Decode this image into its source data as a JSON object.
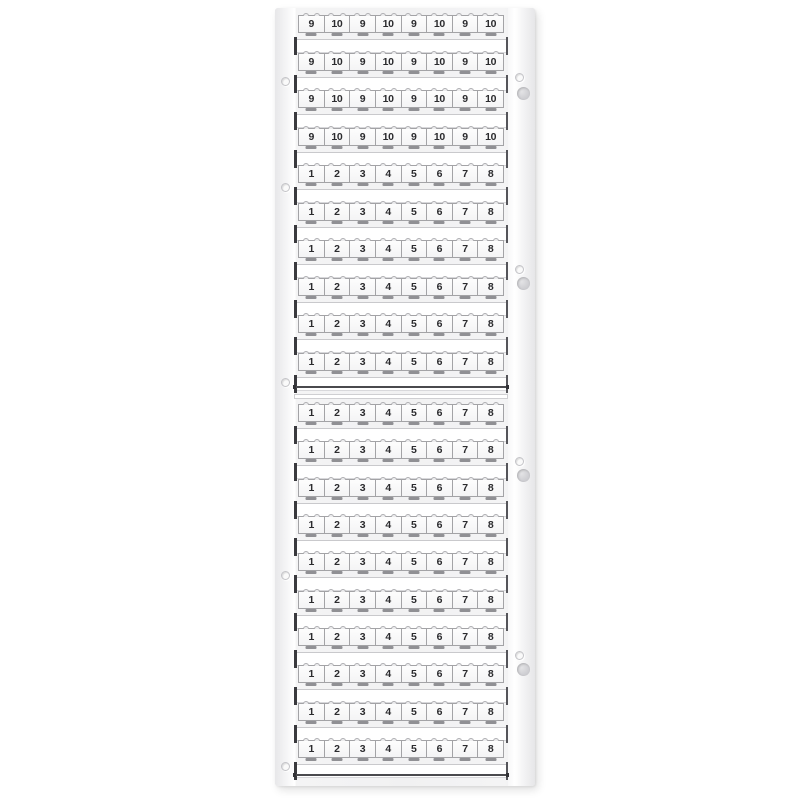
{
  "card": {
    "tag_rows": {
      "pattern_910": [
        "9",
        "10",
        "9",
        "10",
        "9",
        "10",
        "9",
        "10"
      ],
      "pattern_18": [
        "1",
        "2",
        "3",
        "4",
        "5",
        "6",
        "7",
        "8"
      ]
    },
    "sections": [
      {
        "name": "upper",
        "rows": [
          "pattern_910",
          "pattern_910",
          "pattern_910",
          "pattern_910",
          "pattern_18",
          "pattern_18",
          "pattern_18",
          "pattern_18",
          "pattern_18",
          "pattern_18"
        ]
      },
      {
        "name": "lower",
        "rows": [
          "pattern_18",
          "pattern_18",
          "pattern_18",
          "pattern_18",
          "pattern_18",
          "pattern_18",
          "pattern_18",
          "pattern_18",
          "pattern_18",
          "pattern_18"
        ]
      }
    ],
    "colors": {
      "page_background": "#ffffff",
      "card_body": "#f1f1f2",
      "tag_fill": "#fbfbfc",
      "tag_border": "#a3a3a6",
      "digit": "#2b2b2e",
      "blank_strip": "#ffffff",
      "end_bar": "#3a3a3e",
      "section_line": "#4a4a4e",
      "hole_ring": "#c4c4c8",
      "notch_fill": "#cfcfd3"
    },
    "left_holes_y": [
      69,
      175,
      370,
      563,
      754
    ],
    "right_holes_y": [
      65,
      257,
      449,
      643
    ],
    "right_notches_y": [
      79,
      269,
      461,
      655
    ]
  }
}
